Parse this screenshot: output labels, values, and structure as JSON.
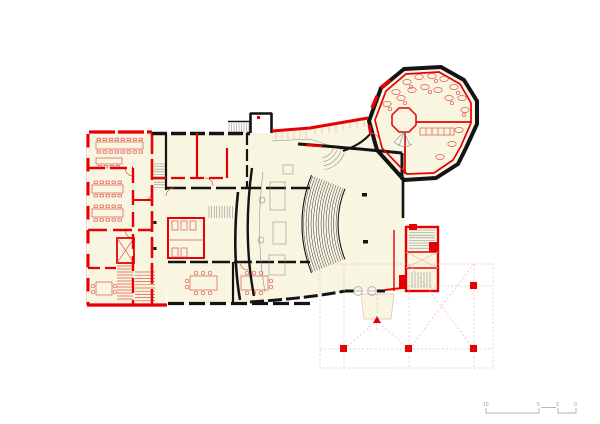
{
  "colors": {
    "page-bg": "#ffffff",
    "floor-fill": "#f8f5e1",
    "wall-red": "#e60005",
    "furniture-red": "#e2554b",
    "window-pink": "#f2b6ac",
    "wall-black": "#141414",
    "detail-gray": "#8a8a8a",
    "scale-gray": "#9a9a9a"
  },
  "scale_bar": {
    "labels": [
      "10",
      "5",
      "2",
      "0"
    ]
  }
}
